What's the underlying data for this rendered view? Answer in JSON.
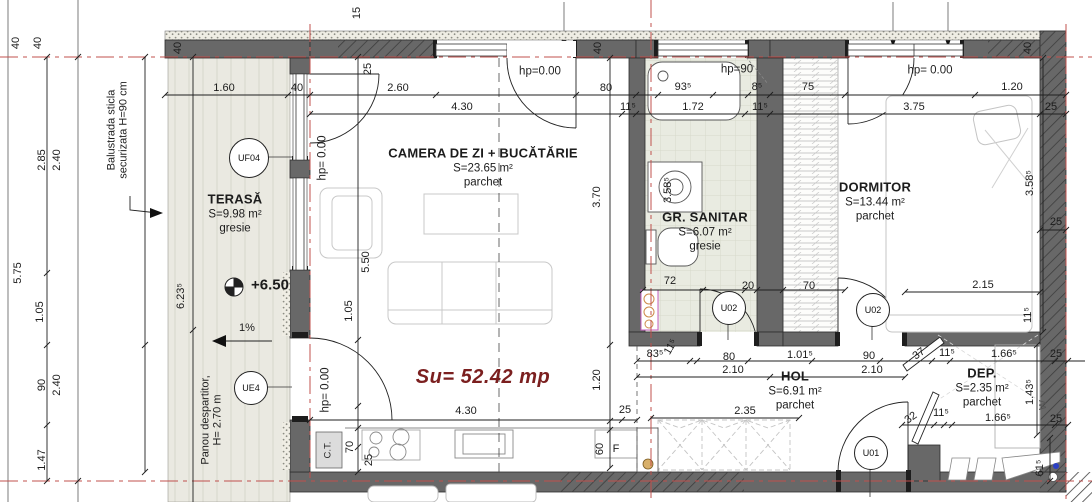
{
  "drawing_type": "apartment floor plan",
  "total_area": {
    "text": "Su= 52.42 mp",
    "x": 483,
    "y": 377
  },
  "colors": {
    "wall_gray": "#686868",
    "axis_red": "#c0504d",
    "total_area_red": "#7b1f1f",
    "terrace_floor": "#eae9e1",
    "sanitary_floor": "#e9ebe1",
    "fixture_pink": "#c65cc0"
  },
  "rooms": [
    {
      "id": "terasa",
      "name": "TERASĂ",
      "area": "S=9.98 m²",
      "floor": "gresie",
      "x": 235,
      "y": 200
    },
    {
      "id": "camera-de-zi",
      "name": "CAMERA DE ZI + BUCĂTĂRIE",
      "area": "S=23.65 m²",
      "floor": "parchet",
      "x": 483,
      "y": 154
    },
    {
      "id": "gr-sanitar",
      "name": "GR. SANITAR",
      "area": "S=6.07 m²",
      "floor": "gresie",
      "x": 705,
      "y": 218
    },
    {
      "id": "dormitor",
      "name": "DORMITOR",
      "area": "S=13.44 m²",
      "floor": "parchet",
      "x": 875,
      "y": 188
    },
    {
      "id": "hol",
      "name": "HOL",
      "area": "S=6.91 m²",
      "floor": "parchet",
      "x": 795,
      "y": 377
    },
    {
      "id": "dep",
      "name": "DEP.",
      "area": "S=2.35 m²",
      "floor": "parchet",
      "x": 982,
      "y": 374
    }
  ],
  "annotations": [
    {
      "t": "Balustrada sticla\nsecurizata H=90 cm",
      "x": 118,
      "y": 130,
      "r": -90,
      "cls": "note",
      "n": "balustrade-note"
    },
    {
      "t": "Panou despartitor,\nH= 2.70 m",
      "x": 212,
      "y": 420,
      "r": -90,
      "cls": "note",
      "n": "partition-panel-note"
    },
    {
      "t": "+6.50",
      "x": 270,
      "y": 286,
      "cls": "level",
      "n": "level-marker-value"
    },
    {
      "t": "1%",
      "x": 247,
      "y": 328,
      "cls": "dim",
      "n": "slope-label"
    }
  ],
  "markers": [
    {
      "id": "UF04",
      "x": 248,
      "y": 157,
      "r": 19
    },
    {
      "id": "UE4",
      "x": 250,
      "y": 387,
      "r": 16
    },
    {
      "id": "U02",
      "x": 728,
      "y": 307,
      "r": 16
    },
    {
      "id": "U02",
      "x": 872,
      "y": 309,
      "r": 16
    },
    {
      "id": "U01",
      "x": 870,
      "y": 452,
      "r": 16
    }
  ],
  "dimensions": [
    {
      "t": "40",
      "x": 16,
      "y": 43,
      "r": -90
    },
    {
      "t": "40",
      "x": 38,
      "y": 43,
      "r": -90
    },
    {
      "t": "40",
      "x": 178,
      "y": 48,
      "r": -90
    },
    {
      "t": "15",
      "x": 357,
      "y": 13,
      "r": -90
    },
    {
      "t": "40",
      "x": 598,
      "y": 48,
      "r": -90
    },
    {
      "t": "40",
      "x": 1028,
      "y": 48,
      "r": -90
    },
    {
      "t": "1.60",
      "x": 224,
      "y": 88
    },
    {
      "t": "40",
      "x": 297,
      "y": 88
    },
    {
      "t": "2.60",
      "x": 398,
      "y": 88
    },
    {
      "t": "80",
      "x": 606,
      "y": 88
    },
    {
      "t": "93⁵",
      "x": 683,
      "y": 87
    },
    {
      "t": "8⁵",
      "x": 757,
      "y": 87
    },
    {
      "t": "75",
      "x": 808,
      "y": 87
    },
    {
      "t": "1.20",
      "x": 1012,
      "y": 87
    },
    {
      "t": "4.30",
      "x": 462,
      "y": 107
    },
    {
      "t": "11⁵",
      "x": 628,
      "y": 107
    },
    {
      "t": "1.72",
      "x": 693,
      "y": 107
    },
    {
      "t": "11⁵",
      "x": 760,
      "y": 107
    },
    {
      "t": "3.75",
      "x": 914,
      "y": 107
    },
    {
      "t": "25",
      "x": 1051,
      "y": 107
    },
    {
      "t": "25",
      "x": 368,
      "y": 69,
      "r": -90
    },
    {
      "t": "hp=0.00",
      "x": 540,
      "y": 72,
      "cls": "hp"
    },
    {
      "t": "hp=90",
      "x": 737,
      "y": 70,
      "cls": "hp"
    },
    {
      "t": "hp= 0.00",
      "x": 930,
      "y": 71,
      "cls": "hp"
    },
    {
      "t": "hp= 0.00",
      "x": 323,
      "y": 158,
      "r": -90,
      "cls": "hp"
    },
    {
      "t": "hp= 0.00",
      "x": 326,
      "y": 390,
      "r": -90,
      "cls": "hp"
    },
    {
      "t": "2.85",
      "x": 42,
      "y": 160,
      "r": -90
    },
    {
      "t": "2.40",
      "x": 57,
      "y": 160,
      "r": -90
    },
    {
      "t": "5.75",
      "x": 18,
      "y": 273,
      "r": -90
    },
    {
      "t": "1.05",
      "x": 40,
      "y": 312,
      "r": -90
    },
    {
      "t": "90",
      "x": 42,
      "y": 385,
      "r": -90
    },
    {
      "t": "2.40",
      "x": 57,
      "y": 385,
      "r": -90
    },
    {
      "t": "1.47",
      "x": 42,
      "y": 460,
      "r": -90
    },
    {
      "t": "6.23⁵",
      "x": 181,
      "y": 296,
      "r": -90
    },
    {
      "t": "5.50",
      "x": 366,
      "y": 262,
      "r": -90
    },
    {
      "t": "1.05",
      "x": 349,
      "y": 311,
      "r": -90
    },
    {
      "t": "3.70",
      "x": 597,
      "y": 197,
      "r": -90
    },
    {
      "t": "1.20",
      "x": 597,
      "y": 380,
      "r": -90
    },
    {
      "t": "4.30",
      "x": 466,
      "y": 411
    },
    {
      "t": "25",
      "x": 625,
      "y": 410
    },
    {
      "t": "70",
      "x": 350,
      "y": 447,
      "r": -90
    },
    {
      "t": "25",
      "x": 369,
      "y": 460,
      "r": -90
    },
    {
      "t": "60",
      "x": 600,
      "y": 449,
      "r": -90
    },
    {
      "t": "F",
      "x": 616,
      "y": 449
    },
    {
      "t": "C.T.",
      "x": 329,
      "y": 450,
      "r": -90,
      "cls": "ct"
    },
    {
      "t": "3.58⁵",
      "x": 668,
      "y": 190,
      "r": -90
    },
    {
      "t": "72",
      "x": 670,
      "y": 281
    },
    {
      "t": "20",
      "x": 748,
      "y": 286
    },
    {
      "t": "70",
      "x": 809,
      "y": 286
    },
    {
      "t": "3.58⁵",
      "x": 1030,
      "y": 183,
      "r": -90
    },
    {
      "t": "25",
      "x": 1056,
      "y": 222
    },
    {
      "t": "2.15",
      "x": 983,
      "y": 285
    },
    {
      "t": "11⁵",
      "x": 1028,
      "y": 315,
      "r": -90
    },
    {
      "t": "83⁵",
      "x": 655,
      "y": 354
    },
    {
      "t": "11⁵",
      "x": 671,
      "y": 347,
      "r": -60
    },
    {
      "t": "80",
      "x": 729,
      "y": 357
    },
    {
      "t": "2.10",
      "x": 733,
      "y": 370
    },
    {
      "t": "1.01⁵",
      "x": 800,
      "y": 355
    },
    {
      "t": "90",
      "x": 869,
      "y": 356
    },
    {
      "t": "2.10",
      "x": 872,
      "y": 370
    },
    {
      "t": "37",
      "x": 919,
      "y": 354,
      "r": -35
    },
    {
      "t": "11⁵",
      "x": 947,
      "y": 353
    },
    {
      "t": "1.66⁵",
      "x": 1004,
      "y": 354
    },
    {
      "t": "25",
      "x": 1056,
      "y": 354
    },
    {
      "t": "2.35",
      "x": 745,
      "y": 411
    },
    {
      "t": "32",
      "x": 911,
      "y": 418,
      "r": -35
    },
    {
      "t": "11⁵",
      "x": 941,
      "y": 413
    },
    {
      "t": "1.66⁵",
      "x": 998,
      "y": 418
    },
    {
      "t": "25",
      "x": 1056,
      "y": 419
    },
    {
      "t": "1.43⁵",
      "x": 1030,
      "y": 392,
      "r": -90
    },
    {
      "t": "W",
      "x": 1044,
      "y": 405,
      "r": -90,
      "cls": "w"
    },
    {
      "t": "61⁵",
      "x": 1040,
      "y": 468,
      "r": -90
    }
  ]
}
